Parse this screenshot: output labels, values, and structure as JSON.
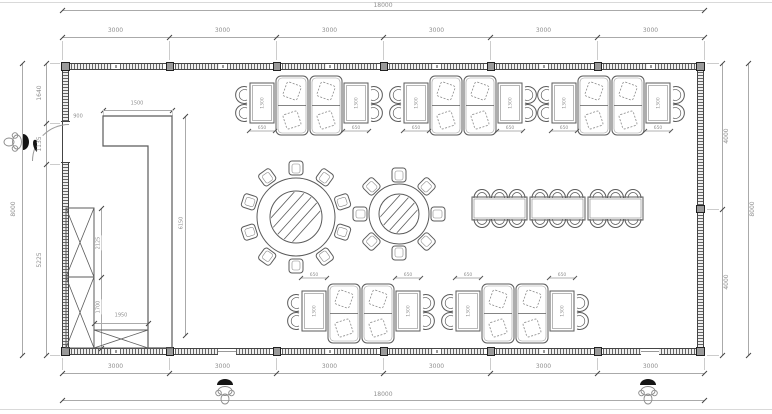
{
  "drawing": {
    "type": "restaurant dining hall floor plan",
    "line_color": "#5b5b5b",
    "dim_color": "#8f8f8f",
    "wall_color": "#444444"
  },
  "dimensions": {
    "top": {
      "total": "18000",
      "segments": [
        "3000",
        "3000",
        "3000",
        "3000",
        "3000",
        "3000"
      ]
    },
    "bottom": {
      "total": "18000",
      "segments": [
        "3000",
        "3000",
        "3000",
        "3000",
        "3000",
        "3000"
      ]
    },
    "left": {
      "total": "8000",
      "segments": [
        "1640",
        "1135",
        "5225"
      ]
    },
    "right": {
      "total": "8000",
      "segments": [
        "4000",
        "4000"
      ]
    }
  },
  "annotations": {
    "door_width": "900",
    "counter_width": "1500",
    "counter_length": "6150",
    "cabinet_upper_height": "2125",
    "cabinet_lower_height": "1700",
    "cabinet_bottom_width": "1950",
    "booth_table_width": "650",
    "booth_table_length": "1300"
  },
  "furniture": {
    "booth_clusters": [
      {
        "x": 235,
        "y": 76,
        "dim": "below"
      },
      {
        "x": 389,
        "y": 76,
        "dim": "below"
      },
      {
        "x": 537,
        "y": 76,
        "dim": "below"
      },
      {
        "x": 287,
        "y": 284,
        "dim": "above"
      },
      {
        "x": 441,
        "y": 284,
        "dim": "above"
      }
    ],
    "round_tables": [
      {
        "cx": 296,
        "cy": 217,
        "outer_r": 39,
        "inner_r": 26,
        "chairs": 10,
        "orbit": 49
      },
      {
        "cx": 399,
        "cy": 214,
        "outer_r": 30,
        "inner_r": 20,
        "chairs": 8,
        "orbit": 39
      }
    ],
    "long_tables": {
      "xs": [
        472,
        530,
        588
      ],
      "y": 197,
      "w": 55,
      "h": 23,
      "chairs_per_side": 3
    },
    "cabinets": [
      {
        "x": 66,
        "y": 208,
        "w": 28,
        "h": 69
      },
      {
        "x": 66,
        "y": 277,
        "w": 28,
        "h": 71
      },
      {
        "x": 94,
        "y": 330,
        "w": 54,
        "h": 18
      }
    ],
    "counter": {
      "path": "M103,116 H172 V348 H148 V146 H103 Z"
    }
  },
  "people": [
    {
      "at": "left-entry-door"
    },
    {
      "at": "bottom-left-entry"
    },
    {
      "at": "bottom-right-entry"
    }
  ]
}
